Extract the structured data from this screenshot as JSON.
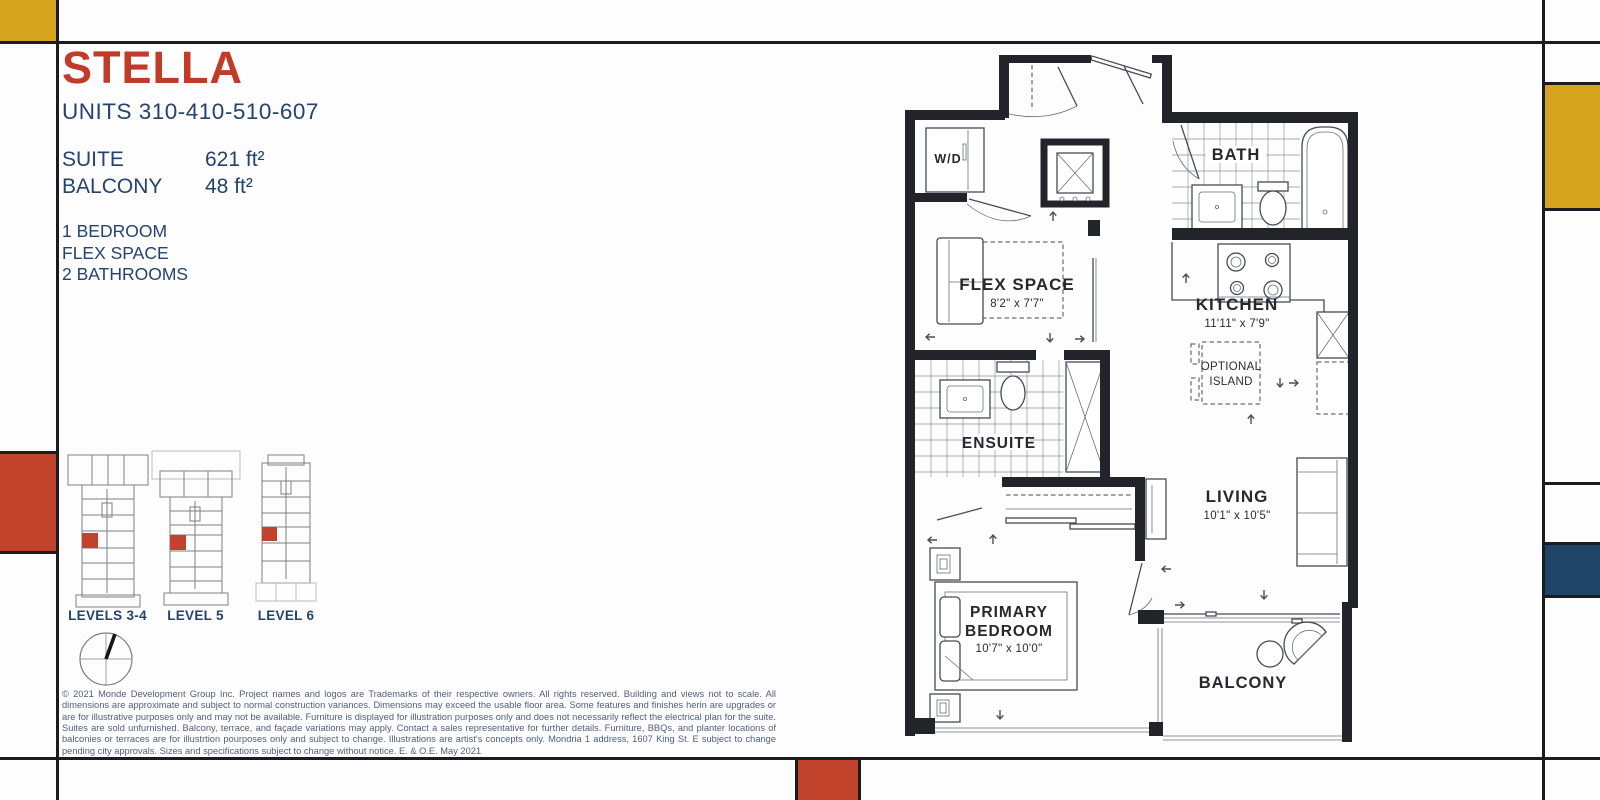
{
  "header": {
    "title": "STELLA",
    "units": "UNITS 310-410-510-607"
  },
  "stats": {
    "rows": [
      {
        "label": "SUITE",
        "value": "621 ft²"
      },
      {
        "label": "BALCONY",
        "value": "48 ft²"
      }
    ]
  },
  "features": [
    "1 BEDROOM",
    "FLEX SPACE",
    "2 BATHROOMS"
  ],
  "levels": [
    {
      "label": "LEVELS 3-4"
    },
    {
      "label": "LEVEL 5"
    },
    {
      "label": "LEVEL 6"
    }
  ],
  "floorplan": {
    "wd_label": "W/D",
    "bath": "BATH",
    "flex_name": "FLEX SPACE",
    "flex_dims": "8'2\" x 7'7\"",
    "kitchen_name": "KITCHEN",
    "kitchen_dims": "11'11\" x 7'9\"",
    "island_line1": "OPTIONAL",
    "island_line2": "ISLAND",
    "ensuite": "ENSUITE",
    "living_name": "LIVING",
    "living_dims": "10'1\" x 10'5\"",
    "primary_line1": "PRIMARY",
    "primary_line2": "BEDROOM",
    "primary_dims": "10'7\" x 10'0\"",
    "balcony": "BALCONY"
  },
  "disclaimer": "© 2021 Monde Development Group Inc.  Project names and logos are Trademarks of their respective owners.  All rights reserved.  Building and views not to scale.  All dimensions are approximate and subject to normal construction variances.  Dimensions may exceed the usable floor area.  Some features and finishes herin are upgrades or are for illustrative purposes only and may not be available.  Furniture is displayed for illustration purposes only and does not necessarily reflect the electrical plan for the suite.  Suites are sold unfurnished.  Balcony, terrace, and façade variations may apply.  Contact a sales representative for further details.  Furniture, BBQs, and planter locations of balconies or terraces are for illustrtion pourposes only and subject to change.  Illustrations are artist's concepts only.  Mondria 1 address, 1607 King St. E subject to change pending city approvals.  Sizes and specifications subject to change without notice. E. & O.E. May 2021",
  "colors": {
    "brand_red": "#C23A28",
    "navy_text": "#24436E",
    "mondrian_yellow": "#D5A31D",
    "mondrian_blue": "#1F4569",
    "mondrian_red": "#C2432C",
    "frame_line": "#1B1C21"
  }
}
